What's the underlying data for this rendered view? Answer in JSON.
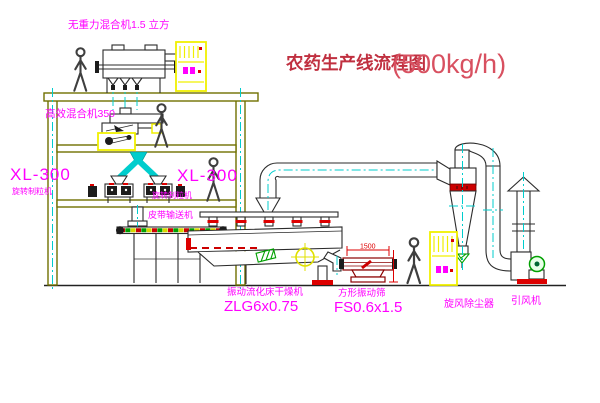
{
  "title": {
    "main": "农药生产线流程图",
    "capacity": "(500kg/h)"
  },
  "equipment_labels": {
    "top_mixer": "无重力混合机1.5 立方",
    "high_eff_mixer": "高效混合机350",
    "granulator_left_model": "XL-300",
    "granulator_left_name": "旋转制粒机",
    "granulator_right_model": "XL-300",
    "granulator_right_name": "旋转制粒机",
    "belt_conveyor": "皮带输送机",
    "dryer_name": "振动流化床干燥机",
    "dryer_model": "ZLG6x0.75",
    "sieve_name": "方形振动筛",
    "sieve_model": "FS0.6x1.5",
    "cyclone": "旋风除尘器",
    "fan": "引风机"
  },
  "dimensions": {
    "sieve_length": "1500"
  },
  "colors": {
    "structure_olive": "#707000",
    "centerline_cyan": "#00cdcd",
    "label_magenta": "#ff00ff",
    "accent_red": "#dd0000",
    "cabinet_yellow": "#f0f000",
    "symbol_green": "#00a000",
    "title_red": "#c03040"
  }
}
